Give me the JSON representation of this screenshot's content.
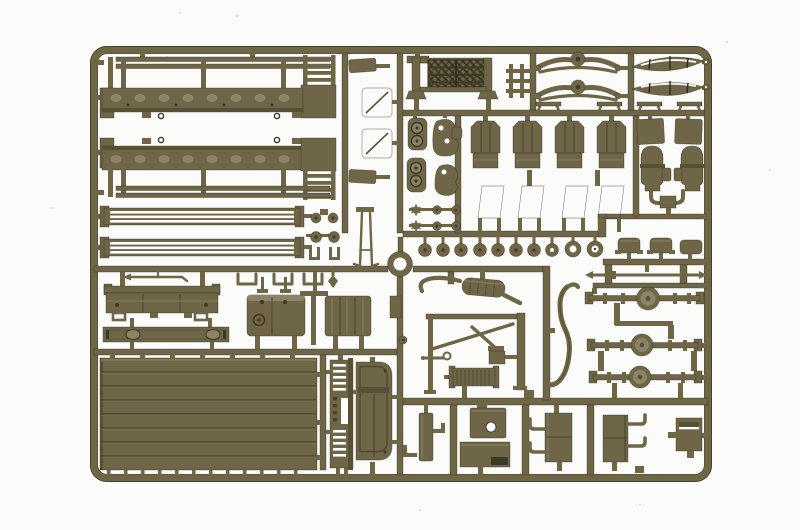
{
  "scene": {
    "type": "photograph",
    "subject": "olive-drab injection-molded model kit sprue with military truck parts on a white background",
    "background_color": "#fbfbfa",
    "speckle_color": "#d8d7d1"
  },
  "palette": {
    "base": "#6e6647",
    "light": "#8b8366",
    "lighter": "#9c946f",
    "mid": "#575034",
    "dark": "#3f3a28",
    "deep": "#2d2a1b",
    "white": "#ffffff"
  },
  "parts": [
    {
      "name": "sprue-frame",
      "label": "outer molded frame with rounded corners"
    },
    {
      "name": "runner-network",
      "label": "internal sprue runner bars"
    },
    {
      "name": "stake-side-panel-top",
      "label": "cargo bed stake side panel (upper)"
    },
    {
      "name": "stake-side-panel-bottom",
      "label": "cargo bed stake side panel (lower, mirrored)"
    },
    {
      "name": "slat-rail-top",
      "label": "slatted side rail (upper)"
    },
    {
      "name": "slat-rail-bottom",
      "label": "slatted side rail (lower)"
    },
    {
      "name": "rail-end-hardware",
      "label": "small knobs and fork fittings"
    },
    {
      "name": "bracket-clips",
      "label": "U-shaped bracket clips"
    },
    {
      "name": "crank-handle",
      "label": "starter crank rod"
    },
    {
      "name": "tailgate-panel",
      "label": "tailgate with hook loops"
    },
    {
      "name": "footboard-strip",
      "label": "flat strip with two oval bosses"
    },
    {
      "name": "fuel-tank",
      "label": "fuel tank with filler caps"
    },
    {
      "name": "connector-tee",
      "label": "tee-shaped runner"
    },
    {
      "name": "tool-box",
      "label": "three-lobed stowage box"
    },
    {
      "name": "cargo-bed-panel",
      "label": "large planked cargo bed floor"
    },
    {
      "name": "front-grille-panel",
      "label": "slatted radiator grille panel"
    },
    {
      "name": "cab-rear-panel",
      "label": "cab rear wall panel"
    },
    {
      "name": "center-ring",
      "label": "round ring part at sprue center"
    },
    {
      "name": "wing-window-frames",
      "label": "small window frames with diagonal braces"
    },
    {
      "name": "wiper-arms",
      "label": "thin wiper/antenna rods"
    },
    {
      "name": "mesh-screen",
      "label": "diamond mesh screen with posts"
    },
    {
      "name": "mini-ladder",
      "label": "small ladder piece"
    },
    {
      "name": "leaf-springs",
      "label": "two leaf-spring bowtie assemblies"
    },
    {
      "name": "drive-shafts",
      "label": "two lens-shaped spring/shaft bundles"
    },
    {
      "name": "mounting-benches",
      "label": "four bench-shaped mounts"
    },
    {
      "name": "seat-backs",
      "label": "four ribbed seat backs with cushions"
    },
    {
      "name": "window-frames",
      "label": "four tilted open window frames"
    },
    {
      "name": "headlight-plates",
      "label": "plates with twin round bosses"
    },
    {
      "name": "housing-blobs",
      "label": "organic housing castings with holes"
    },
    {
      "name": "hardware-knobs",
      "label": "star washers and round knobs"
    },
    {
      "name": "wheel-discs",
      "label": "row of wheel hub discs and rings"
    },
    {
      "name": "hub-caps",
      "label": "three flanged hub caps"
    },
    {
      "name": "tie-rod",
      "label": "tie rod with pointed ends"
    },
    {
      "name": "axles",
      "label": "three axles with differential housings"
    },
    {
      "name": "exhaust-assembly",
      "label": "muffler with curved tip pipe"
    },
    {
      "name": "tow-frame",
      "label": "A-frame with mast and hook rod"
    },
    {
      "name": "oil-cooler",
      "label": "small ribbed cooler and box"
    },
    {
      "name": "long-exhaust-pipe",
      "label": "long S-curved exhaust pipe"
    },
    {
      "name": "side-plate",
      "label": "small plate and knob on center runner"
    },
    {
      "name": "door-panel-part",
      "label": "narrow door panel with brackets"
    },
    {
      "name": "plate-with-hole",
      "label": "plate pierced by round hole"
    },
    {
      "name": "battery-box",
      "label": "battery box with dark slot"
    },
    {
      "name": "step-box-left",
      "label": "step box with left-hand stirrups"
    },
    {
      "name": "step-box-right",
      "label": "step box with right-hand stirrups"
    },
    {
      "name": "storage-bin",
      "label": "open storage bin"
    },
    {
      "name": "air-tanks",
      "label": "two cylindrical tanks with plates and Y-connector"
    },
    {
      "name": "speckles",
      "label": "faint dust speckles on backdrop"
    }
  ]
}
